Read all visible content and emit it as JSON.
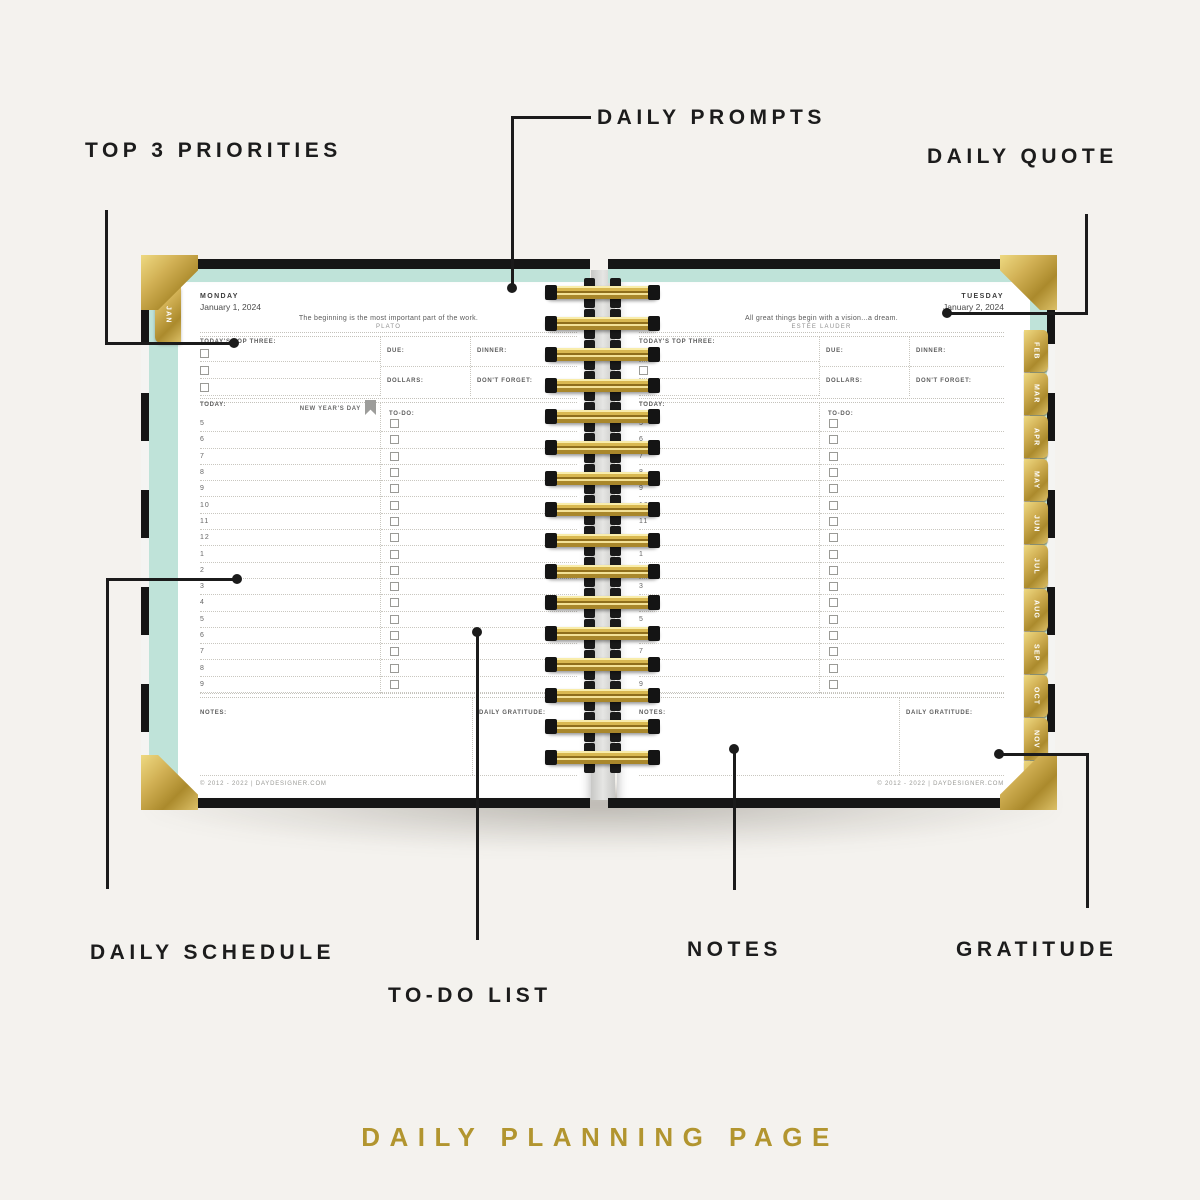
{
  "colors": {
    "background": "#f4f2ee",
    "ink": "#1b1b1b",
    "gold": "#b2952f",
    "mint": "#bfe3d9",
    "tab_gold": "#cfae4e",
    "flag_gray": "#9d9d9b"
  },
  "callouts": {
    "top_priorities": "TOP 3 PRIORITIES",
    "daily_prompts": "DAILY PROMPTS",
    "daily_quote": "DAILY QUOTE",
    "daily_schedule": "DAILY SCHEDULE",
    "todo_list": "TO-DO LIST",
    "notes": "NOTES",
    "gratitude": "GRATITUDE"
  },
  "caption": "DAILY PLANNING PAGE",
  "tabs": {
    "jan": "JAN",
    "months": [
      "FEB",
      "MAR",
      "APR",
      "MAY",
      "JUN",
      "JUL",
      "AUG",
      "SEP",
      "OCT",
      "NOV",
      "DEC"
    ]
  },
  "left_page": {
    "day": "MONDAY",
    "date": "January 1, 2024",
    "quote": "The beginning is the most important part of the work.",
    "author": "PLATO",
    "labels": {
      "top_three": "TODAY'S TOP THREE:",
      "due": "DUE:",
      "dinner": "DINNER:",
      "dollars": "DOLLARS:",
      "dont_forget": "DON'T FORGET:",
      "today": "TODAY:",
      "todo": "TO-DO:",
      "notes": "NOTES:",
      "gratitude": "DAILY GRATITUDE:"
    },
    "holiday": "NEW YEAR'S DAY",
    "times": [
      "5",
      "6",
      "7",
      "8",
      "9",
      "10",
      "11",
      "12",
      "1",
      "2",
      "3",
      "4",
      "5",
      "6",
      "7",
      "8",
      "9"
    ],
    "footer": "© 2012 - 2022 | DAYDESIGNER.COM"
  },
  "right_page": {
    "day": "TUESDAY",
    "date": "January 2, 2024",
    "quote": "All great things begin with a vision...a dream.",
    "author": "ESTÉE LAUDER",
    "labels": {
      "top_three": "TODAY'S TOP THREE:",
      "due": "DUE:",
      "dinner": "DINNER:",
      "dollars": "DOLLARS:",
      "dont_forget": "DON'T FORGET:",
      "today": "TODAY:",
      "todo": "TO-DO:",
      "notes": "NOTES:",
      "gratitude": "DAILY GRATITUDE:"
    },
    "times": [
      "5",
      "6",
      "7",
      "8",
      "9",
      "10",
      "11",
      "12",
      "1",
      "2",
      "3",
      "4",
      "5",
      "6",
      "7",
      "8",
      "9"
    ],
    "footer": "© 2012 - 2022 | DAYDESIGNER.COM"
  }
}
